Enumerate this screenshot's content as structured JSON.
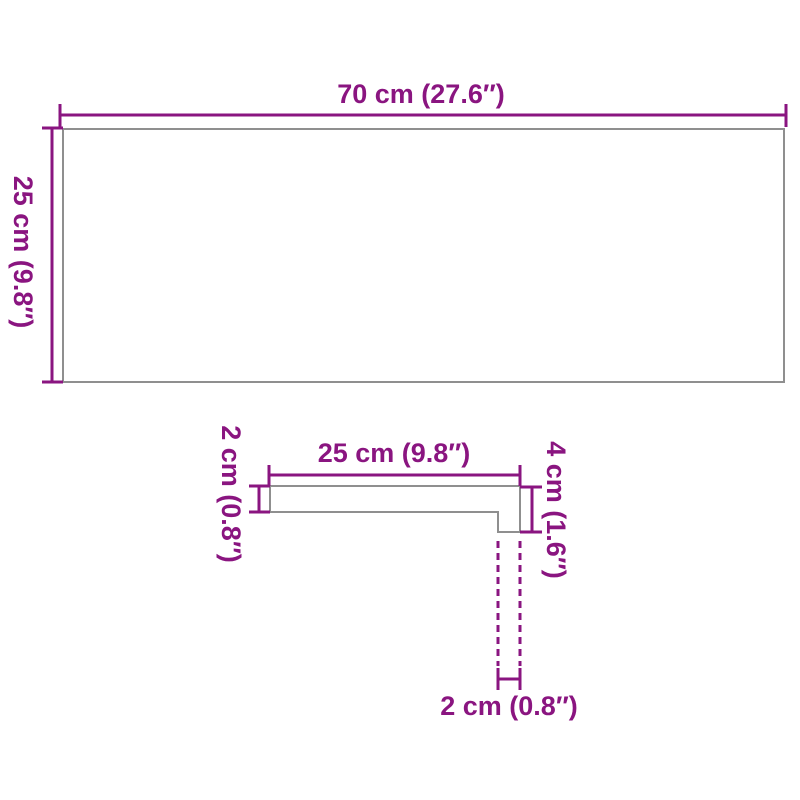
{
  "diagram": {
    "type": "product-dimension-drawing",
    "colors": {
      "dimension_accent": "#8A1580",
      "outline_gray": "#8F8F8F",
      "background": "#FFFFFF"
    },
    "top_view": {
      "width_label": "70 cm (27.6″)",
      "height_label": "25 cm (9.8″)"
    },
    "profile_view": {
      "length_label": "25 cm (9.8″)",
      "thickness_label": "2 cm (0.8″)",
      "edge_height_label": "4 cm (1.6″)",
      "edge_depth_label": "2 cm (0.8″)"
    }
  }
}
